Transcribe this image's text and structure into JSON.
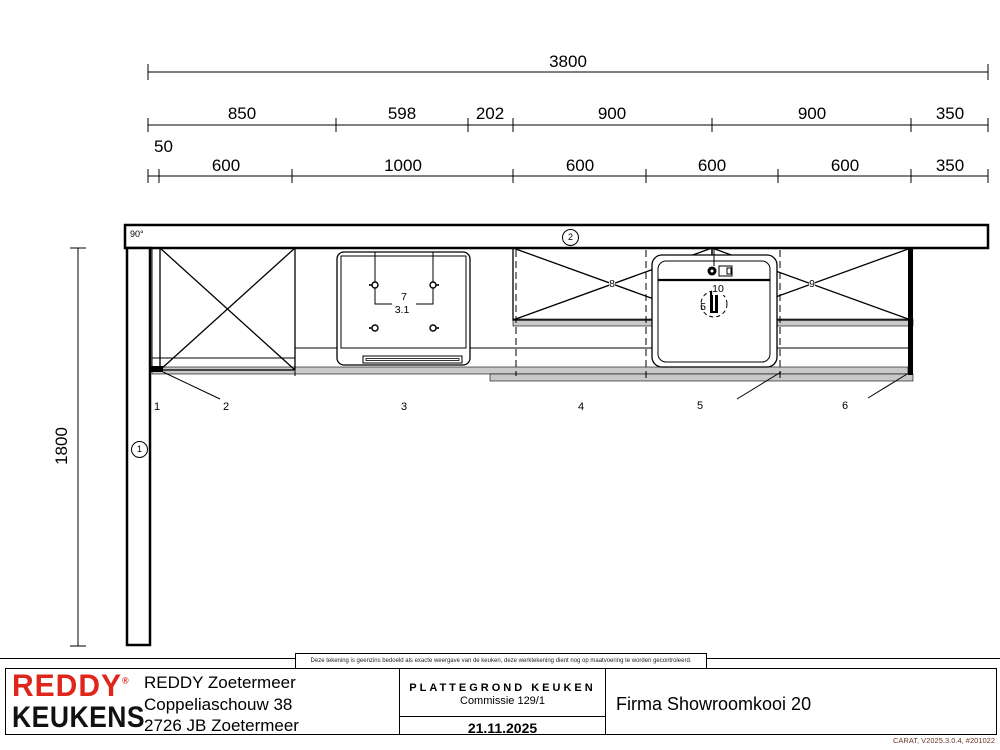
{
  "dimensions": {
    "total": "3800",
    "upper_row": [
      "850",
      "598",
      "202",
      "900",
      "900",
      "350"
    ],
    "lower_row": [
      "600",
      "1000",
      "600",
      "600",
      "600",
      "350"
    ],
    "offset": "50",
    "left_wall": "1800",
    "corner_angle": "90°"
  },
  "plan": {
    "wall_tags": {
      "left": "1",
      "top": "2"
    },
    "cabinet_numbers": [
      "1",
      "2",
      "3",
      "4",
      "5",
      "6"
    ],
    "items": {
      "hob": "7",
      "hob_sub": "3.1",
      "wall_cabinet_left": "8",
      "wall_cabinet_right": "9",
      "faucet": "10",
      "sink": "5"
    }
  },
  "footer": {
    "logo_line1": "REDDY",
    "logo_reg": "®",
    "logo_line2": "KEUKENS",
    "address": [
      "REDDY Zoetermeer",
      "Coppeliaschouw 38",
      "2726 JB Zoetermeer"
    ],
    "doc_type": "PLATTEGROND KEUKEN",
    "commission": "Commissie 129/1",
    "date": "21.11.2025",
    "customer": "Firma Showroomkooi 20",
    "disclaimer": "Deze tekening is geenzins bedoeld als exacte weergave van de keuken, deze werktekening dient nog op maatvoering te worden gecontroleerd.",
    "software_version": "CARAT,  V2025.3.0.4,  #201022"
  },
  "colors": {
    "brand_red": "#e0251b",
    "line": "#000000",
    "countertop_gray": "#c9c9c9",
    "software_text": "#6b3424"
  }
}
